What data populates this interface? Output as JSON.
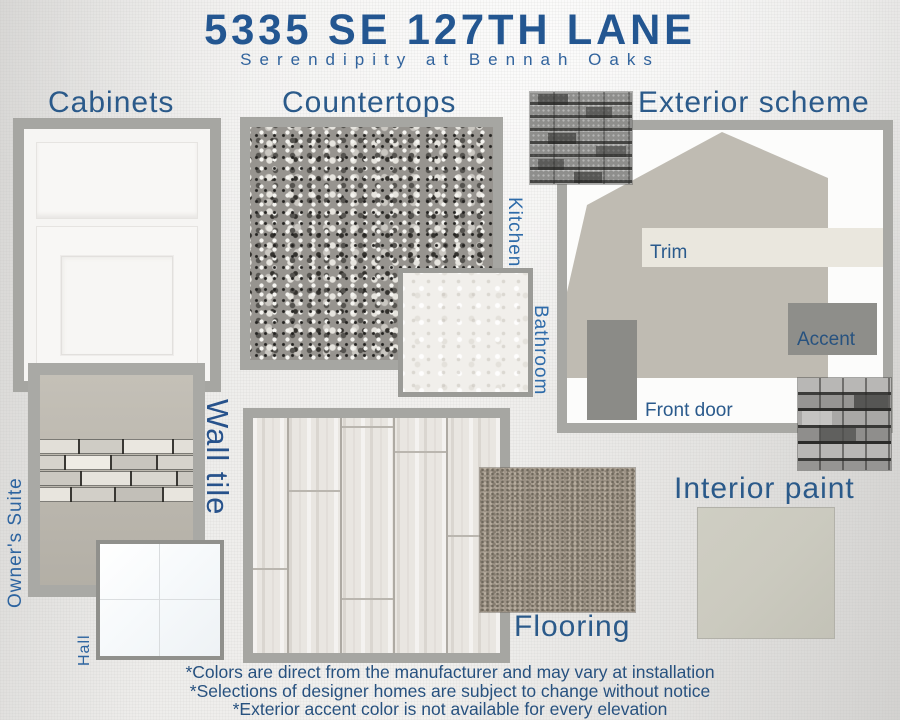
{
  "header": {
    "title": "5335 SE 127TH LANE",
    "subtitle": "Serendipity at Bennah Oaks"
  },
  "sections": {
    "cabinets": {
      "heading": "Cabinets"
    },
    "countertops": {
      "heading": "Countertops",
      "labels": {
        "kitchen": "Kitchen",
        "bathroom": "Bathroom"
      }
    },
    "exterior": {
      "heading": "Exterior scheme",
      "labels": {
        "trim": "Trim",
        "accent": "Accent",
        "front_door": "Front door"
      }
    },
    "wall_tile": {
      "heading": "Wall tile",
      "labels": {
        "owners_suite": "Owner's Suite",
        "hall": "Hall"
      }
    },
    "flooring": {
      "heading": "Flooring"
    },
    "interior_paint": {
      "heading": "Interior paint"
    }
  },
  "footnotes": [
    "*Colors are direct from the manufacturer and may vary at installation",
    "*Selections of designer homes are subject to change without notice",
    "*Exterior accent color is not available for every elevation"
  ],
  "colors": {
    "title_blue": "#235691",
    "heading_blue": "#2b5a8a",
    "vertical_label_blue": "#2e6ba9",
    "swatch_frame_gray": "#a6a6a2",
    "siding": "#bfbbb2",
    "trim": "#eae7de",
    "accent": "#8e8e8a",
    "front_door": "#8b8b87",
    "interior_paint": "#cbcabf",
    "carpet": "#9c9285",
    "wall_tile_field": "#bdb9b0",
    "background": "#ecebe9"
  }
}
